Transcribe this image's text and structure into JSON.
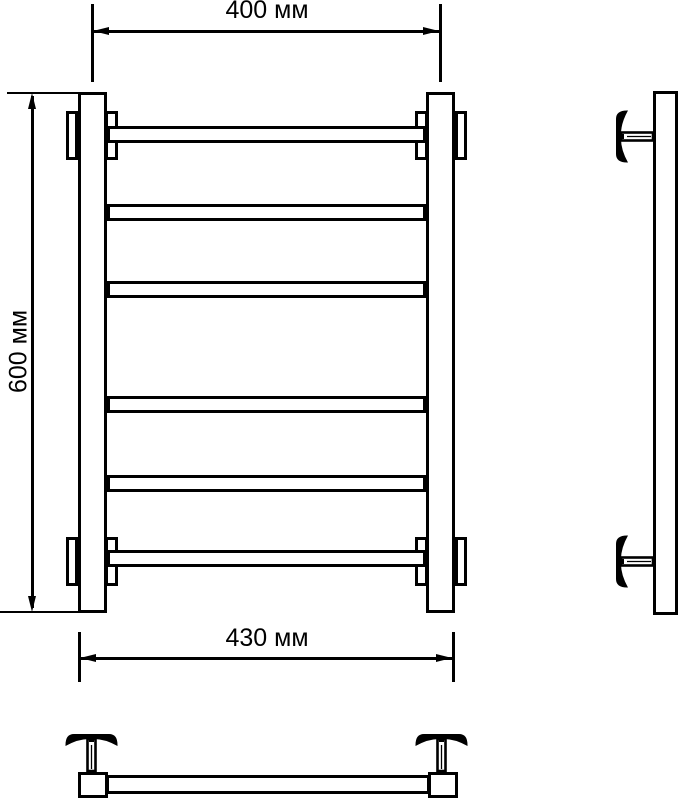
{
  "drawing": {
    "background": "#ffffff",
    "line_color": "#000000",
    "labels": {
      "width_axis": "400 мм",
      "height_overall": "600 мм",
      "width_overall": "430 мм"
    },
    "values": {
      "width_axis_mm": 400,
      "height_overall_mm": 600,
      "width_overall_mm": 430
    },
    "rail_count": 6
  }
}
